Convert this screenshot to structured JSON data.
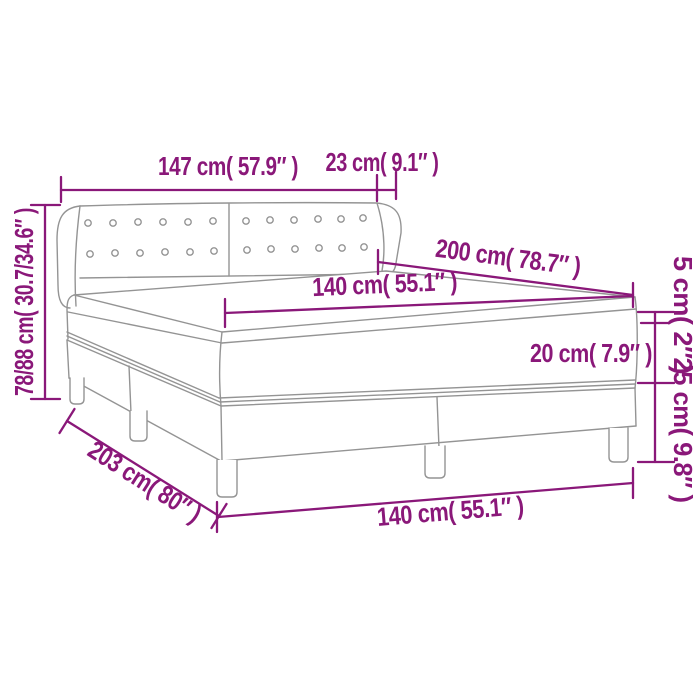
{
  "diagram": {
    "type": "product-dimension-line-drawing",
    "subject": "box-spring-bed-with-tufted-headboard-mattress-and-topper",
    "colors": {
      "dimension": "#8A1879",
      "line_art": "#949494",
      "background": "#FFFFFF"
    },
    "labels": {
      "headboard_width": "147 cm( 57.9″ )",
      "headboard_wing_depth": "23 cm( 9.1″ )",
      "total_height": "78/88 cm( 30.7/34.6″ )",
      "bed_length": "200 cm( 78.7″ )",
      "mattress_width": "140 cm( 55.1″ )",
      "topper_thickness": "5 cm( 2″ )",
      "mattress_thickness": "20 cm( 7.9″ )",
      "base_height": "25 cm( 9.8″ )",
      "base_length": "203 cm( 80″ )",
      "base_width": "140 cm( 55.1″ )"
    }
  }
}
